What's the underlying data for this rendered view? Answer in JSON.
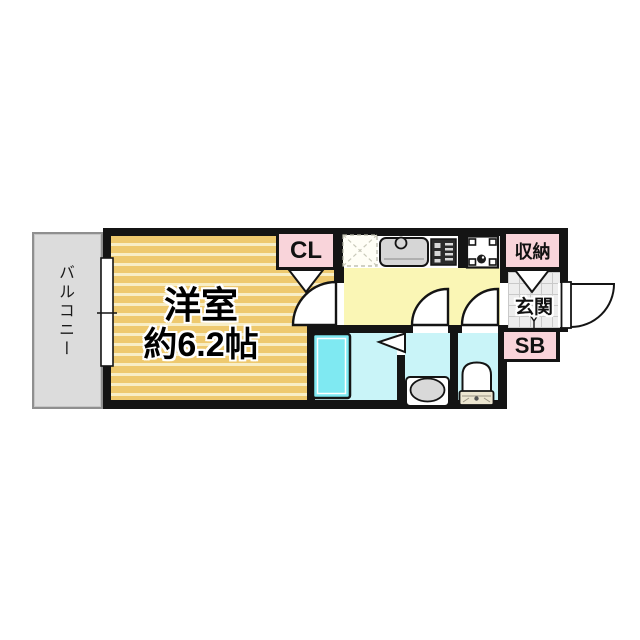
{
  "rooms": {
    "balcony": "バルコニー",
    "living_room_line1": "洋室",
    "living_room_line2": "約6.2帖",
    "closet": "CL",
    "storage": "収納",
    "entrance": "玄関",
    "shoe_box": "SB"
  },
  "colors": {
    "wall": "#141414",
    "room_floor": "#eec96f",
    "room_floor_stripe": "#f8eec6",
    "kitchen_floor": "#faf6b5",
    "wet_room_floor": "#c9f4f8",
    "bathtub": "#7fe9f2",
    "label_pink": "#f9d4da",
    "balcony_gray": "#dcdcdc",
    "entrance_tile": "#ededed"
  }
}
